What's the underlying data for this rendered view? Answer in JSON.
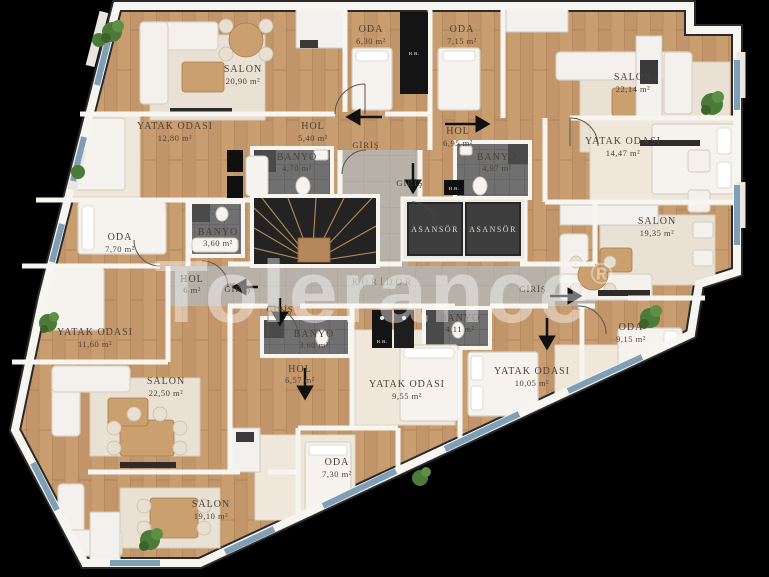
{
  "watermark": {
    "text": "Tolerance",
    "reg": "®"
  },
  "core": {
    "koridor": "KORİDOR",
    "elevator_left": "ASANSÖR",
    "elevator_right": "ASANSÖR",
    "shaft_label_1": "H.B.",
    "shaft_label_2": "H.B.",
    "shaft_label_3": "H.B."
  },
  "units": {
    "top_left": {
      "salon": {
        "name": "SALON",
        "area": "20,90 m²"
      },
      "oda": {
        "name": "ODA",
        "area": "6,30 m²"
      },
      "yatak": {
        "name": "YATAK ODASI",
        "area": "12,80 m²"
      },
      "hol": {
        "name": "HOL",
        "area": "5,40 m²"
      },
      "banyo": {
        "name": "BANYO",
        "area": "4,70 m²"
      },
      "giris": {
        "name": "GİRİŞ"
      }
    },
    "top_right": {
      "oda": {
        "name": "ODA",
        "area": "7,15 m²"
      },
      "salon": {
        "name": "SALON",
        "area": "22,14 m²"
      },
      "hol": {
        "name": "HOL",
        "area": "6,95 m²"
      },
      "banyo": {
        "name": "BANYO",
        "area": "4,97 m²"
      },
      "yatak": {
        "name": "YATAK ODASI",
        "area": "14,47 m²"
      },
      "giris": {
        "name": "GİRİŞ"
      }
    },
    "right": {
      "salon": {
        "name": "SALON",
        "area": "19,35 m²"
      },
      "oda": {
        "name": "ODA",
        "area": "9,15 m²"
      },
      "yatak": {
        "name": "YATAK ODASI",
        "area": "10,05 m²"
      },
      "banyo": {
        "name": "BANYO",
        "area": "4,11 m²"
      },
      "giris": {
        "name": "GİRİŞ"
      }
    },
    "left": {
      "oda": {
        "name": "ODA",
        "area": "7,70 m²"
      },
      "banyo": {
        "name": "BANYO",
        "area": "3,60 m²"
      },
      "hol": {
        "name": "HOL",
        "area": "6 m²"
      },
      "yatak": {
        "name": "YATAK ODASI",
        "area": "11,60 m²"
      },
      "salon": {
        "name": "SALON",
        "area": "22,50 m²"
      },
      "giris": {
        "name": "GİRİŞ"
      }
    },
    "bottom": {
      "banyo": {
        "name": "BANYO",
        "area": "3,60 m²"
      },
      "hol": {
        "name": "HOL",
        "area": "6,57 m²"
      },
      "yatak": {
        "name": "YATAK ODASI",
        "area": "9,55 m²"
      },
      "oda": {
        "name": "ODA",
        "area": "7,30 m²"
      },
      "salon": {
        "name": "SALON",
        "area": "19,10 m²"
      },
      "giris": {
        "name": "GİRİŞ"
      }
    }
  },
  "colors": {
    "background": "#000000",
    "wood_floor": "#c89d6f",
    "wall": "#f7f5f0",
    "bath_tile": "#707070",
    "corridor_tile": "#b7b1a9",
    "elevator": "#3e3e3e",
    "stairs": "#232323",
    "window": "#7f9fb6",
    "plant": "#4c7a38",
    "furniture_white": "#f4f1ec",
    "furniture_wood": "#b5895d",
    "label_text": "#4b4136"
  }
}
